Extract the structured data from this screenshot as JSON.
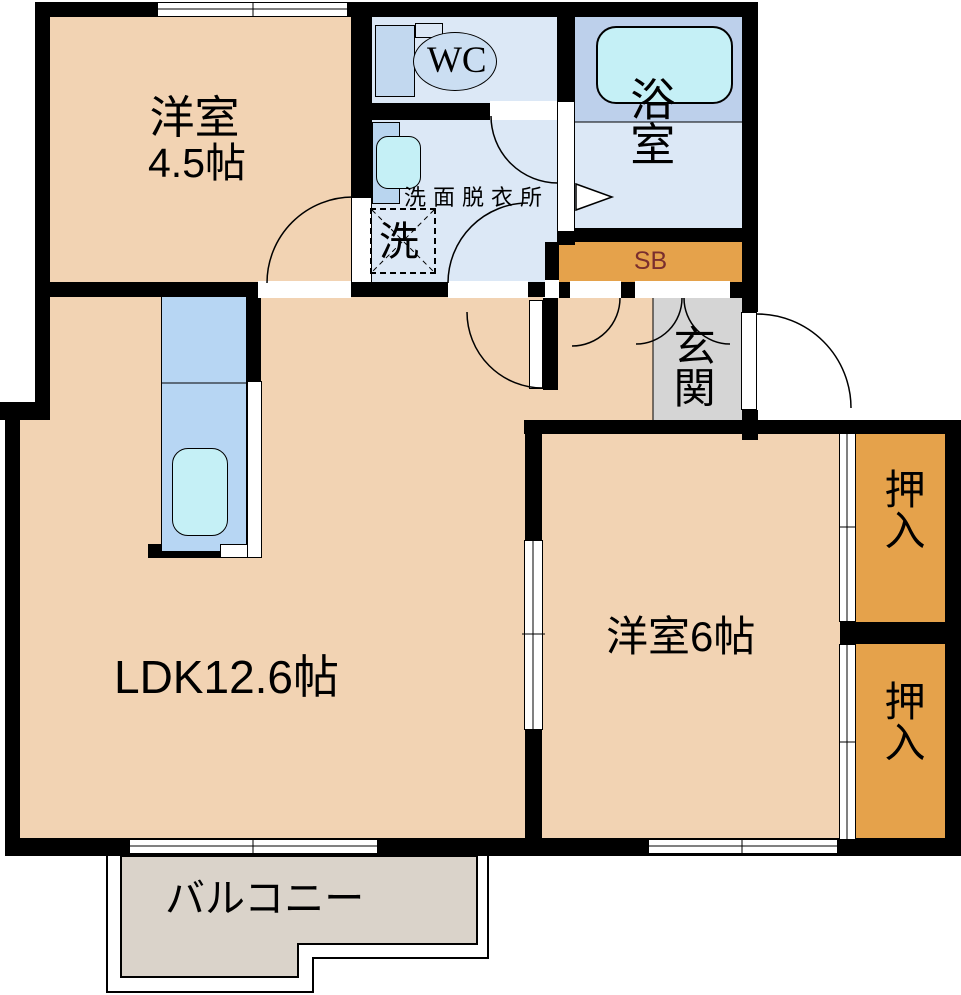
{
  "rooms": {
    "bedroom_45": {
      "name": "洋室",
      "size": "4.5帖"
    },
    "ldk": {
      "label": "LDK12.6帖"
    },
    "bedroom_6": {
      "label": "洋室6帖"
    },
    "bathroom": {
      "label": "浴室"
    },
    "toilet": {
      "label": "WC"
    },
    "washroom": {
      "label": "洗面脱衣所"
    },
    "laundry": {
      "label": "洗"
    },
    "entrance": {
      "label": "玄関"
    },
    "shoe_box": {
      "label": "SB"
    },
    "closet_upper": {
      "label": "押入"
    },
    "closet_lower": {
      "label": "押入"
    },
    "balcony": {
      "label": "バルコニー"
    }
  },
  "colors": {
    "room_floor": "#f2d3b3",
    "storage_orange": "#e5a24b",
    "wet_area_floor": "#dce8f6",
    "bath_upper_zone": "#bdd0eb",
    "fixture_cyan": "#c5f0f6",
    "kitchen_counter": "#b7d6f3",
    "toilet_tank": "#c2d8ef",
    "toilet_bowl": "#cbdef2",
    "entrance_floor": "#d5d5d5",
    "balcony_floor": "#dad3ca",
    "wall": "#000000",
    "sb_text": "#7a2e2e"
  }
}
